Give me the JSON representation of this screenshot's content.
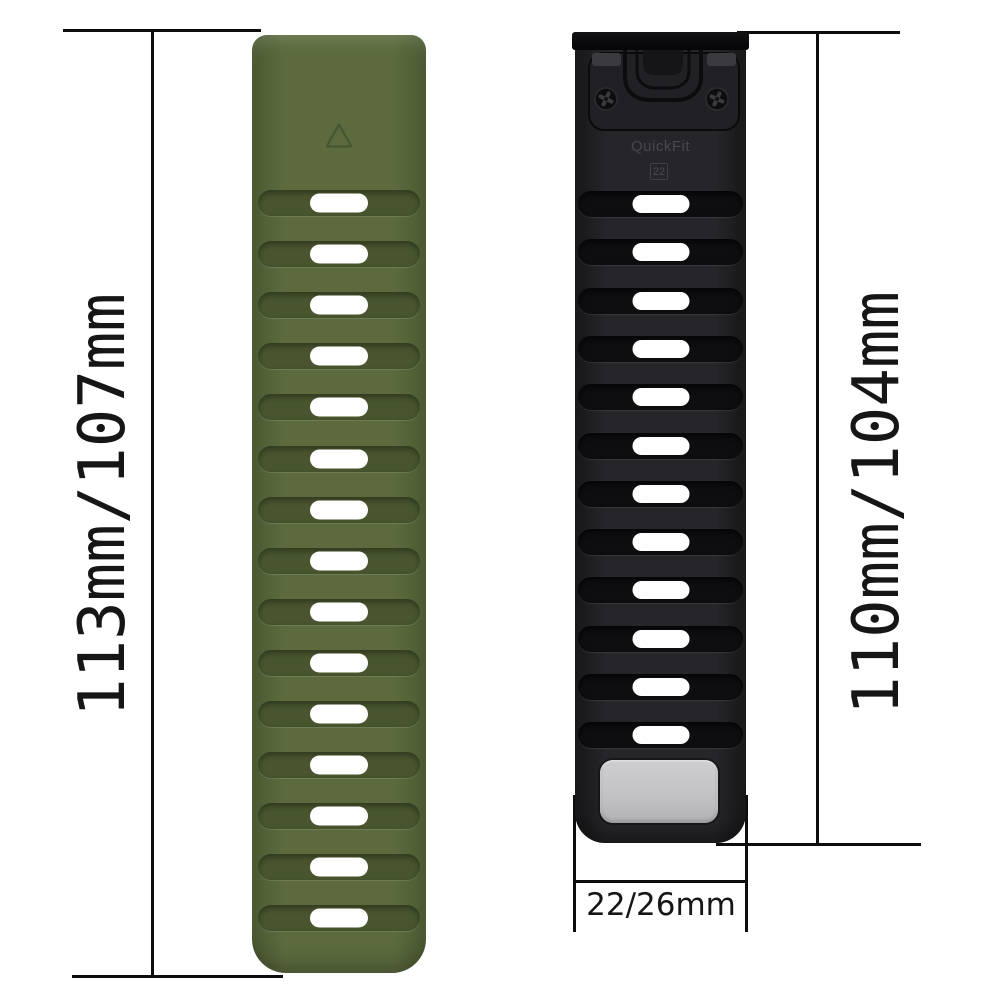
{
  "labels": {
    "left_length": "113mm/107mm",
    "right_length": "110mm/104mm",
    "bottom_width": "22/26mm",
    "connector_brand": "QuickFit",
    "connector_size": "22"
  },
  "colors": {
    "background": "#ffffff",
    "measure_line": "#0d0d0d",
    "label_text": "#161616",
    "slot_white": "#ffffff",
    "gray_plate": "#c3c3c5",
    "connector_bar": "#0a0a0c",
    "connector_plate": "#212125",
    "connector_text": "#47474c",
    "triangle_stroke": "#41502a"
  },
  "icons": {
    "triangle_logo": "triangle-outline",
    "screws": "phillips-screw"
  },
  "bands": {
    "green": {
      "name": "army-green-strap",
      "slot_count": 15,
      "first_slot_center": 168,
      "slot_pitch": 51.1,
      "rib_inset": 6,
      "rib_height": 26,
      "slot_w": 58,
      "slot_h": 19,
      "colors": {
        "body": "#5c6a3e",
        "edge": "#4c5a32",
        "groove": "#48552e",
        "groove_shadow": "rgba(0,0,0,0.35)",
        "rib_highlight": "rgba(255,255,255,0.12)"
      }
    },
    "black": {
      "name": "black-strap",
      "slot_count": 12,
      "first_slot_center": 172,
      "slot_pitch": 48.3,
      "rib_inset": 3,
      "rib_height": 26,
      "slot_w": 57,
      "slot_h": 18,
      "colors": {
        "body": "#26262a",
        "edge": "#17171a",
        "groove": "#0e0e11",
        "groove_shadow": "rgba(0,0,0,0.65)",
        "rib_highlight": "rgba(255,255,255,0.08)"
      }
    }
  }
}
